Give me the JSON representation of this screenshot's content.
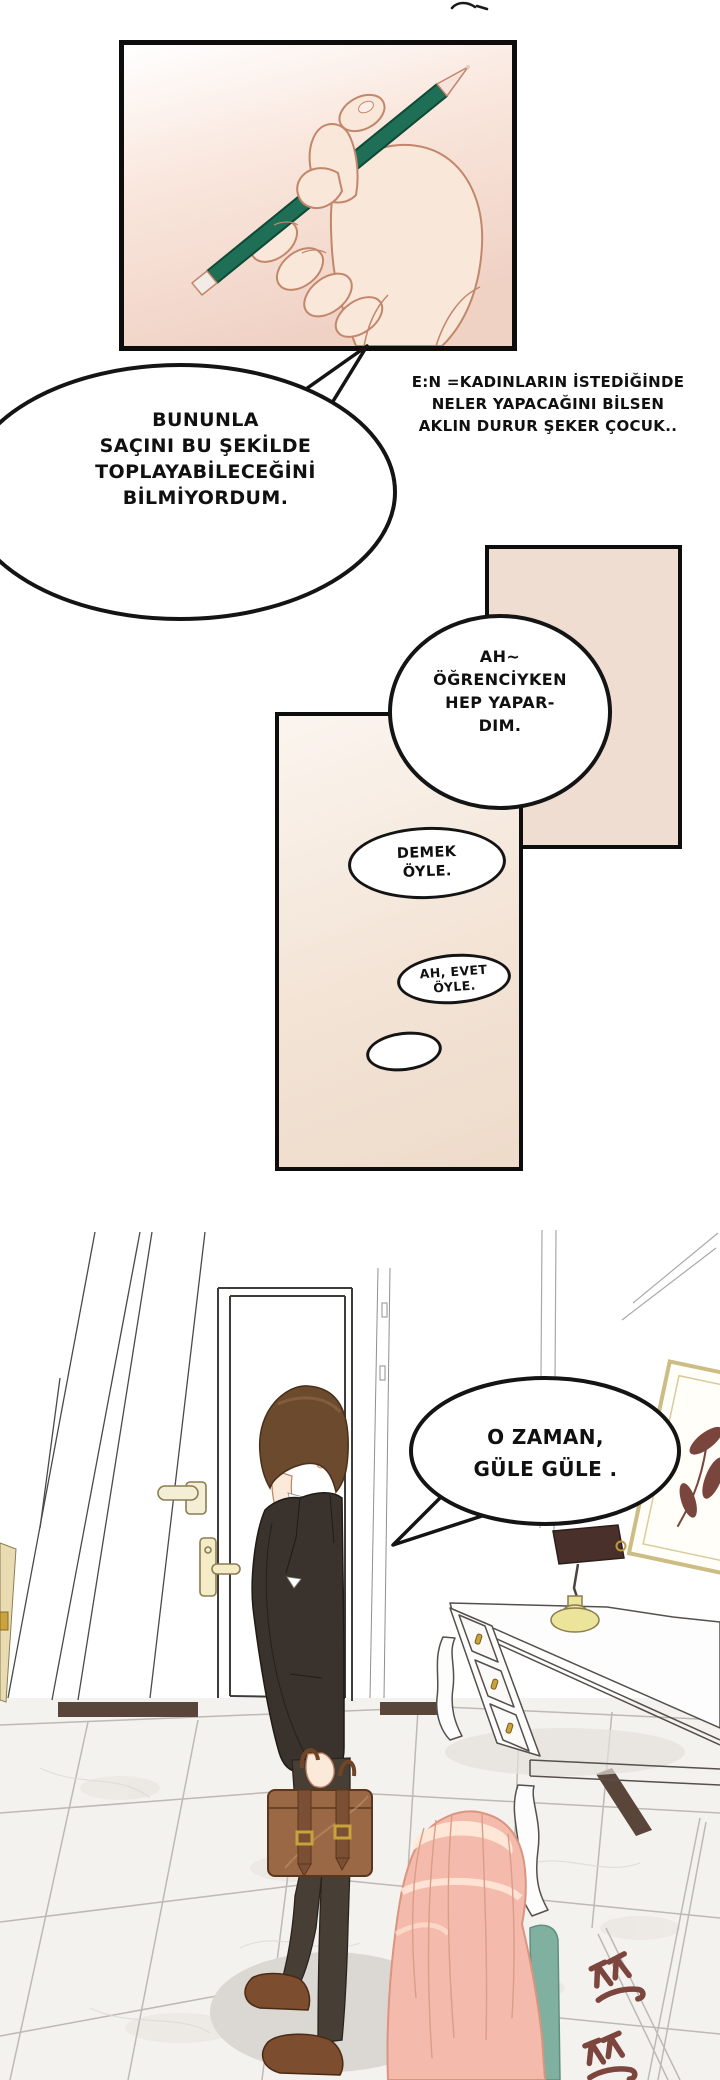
{
  "comic": {
    "editor_note": {
      "lines": [
        "E:N =KADINLARIN İSTEDİĞİNDE",
        "NELER YAPACAĞINI BİLSEN",
        "AKLIN DURUR ŞEKER ÇOCUK.."
      ]
    },
    "bubbles": {
      "b1": {
        "lines": [
          "BUNUNLA",
          "SAÇINI BU ŞEKİLDE",
          "TOPLAYABİLECEĞİNİ",
          "BİLMİYORDUM."
        ]
      },
      "b2": {
        "lines": [
          "AH~",
          "ÖĞRENCİYKEN",
          "HEP YAPAR-",
          "DIM."
        ]
      },
      "b3": {
        "lines": [
          "DEMEK",
          "ÖYLE."
        ]
      },
      "b4": {
        "lines": [
          "AH, EVET",
          "ÖYLE."
        ]
      },
      "b5": {
        "lines": []
      },
      "b6": {
        "lines": [
          "O ZAMAN,",
          "GÜLE GÜLE ."
        ]
      }
    },
    "sfx": {
      "text": "쯔쯔"
    },
    "colors": {
      "panel_border": "#0d0d0d",
      "panel_pink_bottom": "#f1d3c6",
      "beige_panel": "#f0ddd2",
      "pencil_green": "#1e6f55",
      "skin": "#f9e7da",
      "suit": "#3a332d",
      "briefcase": "#9a6845",
      "man_hair": "#6b4a2d",
      "woman_hair": "#f4bbac",
      "sfx_color": "#7c453e",
      "lamp_base": "#ece49b",
      "frame_gold": "#cdbd85"
    }
  }
}
